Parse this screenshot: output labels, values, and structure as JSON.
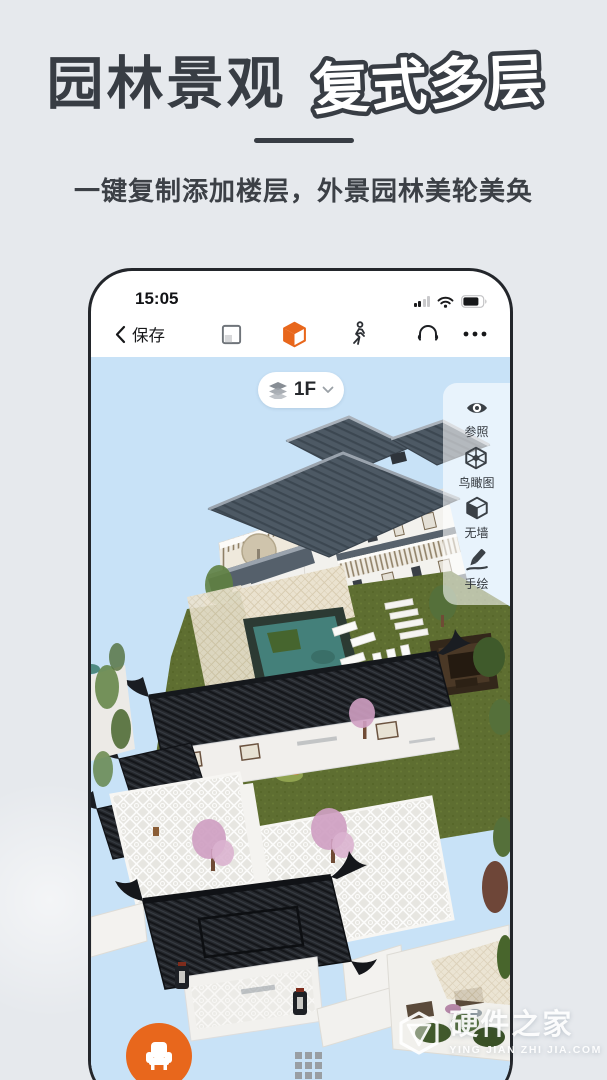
{
  "hero": {
    "title_solid": "园林景观",
    "title_outline": "复式多层",
    "subtitle": "一键复制添加楼层，外景园林美轮美奂"
  },
  "phone": {
    "status": {
      "time": "15:05"
    },
    "toolbar": {
      "back_label": "保存"
    },
    "floor_selector": {
      "label": "1F"
    },
    "side_tools": {
      "items": [
        {
          "icon": "eye-icon",
          "label": "参照"
        },
        {
          "icon": "birdview-cube-icon",
          "label": "鸟瞰图"
        },
        {
          "icon": "no-wall-cube-icon",
          "label": "无墙"
        },
        {
          "icon": "pencil-icon",
          "label": "手绘"
        }
      ]
    }
  },
  "watermark": {
    "title": "硬件之家",
    "subtitle": "YING JIAN ZHI JIA.COM"
  },
  "colors": {
    "accent_orange": "#E8671C",
    "sky_blue": "#C8E2F7",
    "page_bg": "#E6E9ED",
    "ink": "#383D44",
    "roof_slate": "#4C5661",
    "roof_dark": "#24272C",
    "lawn_green": "#5E6E31",
    "pond_teal": "#44807A"
  }
}
